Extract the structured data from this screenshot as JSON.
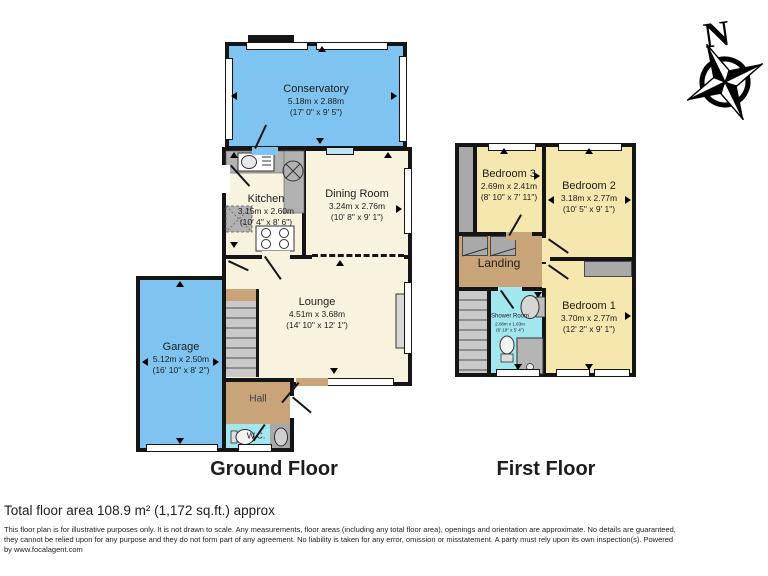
{
  "page": {
    "ground_floor_label": "Ground Floor",
    "first_floor_label": "First Floor",
    "compass_north": "N",
    "total_area": "Total floor area 108.9 m² (1,172 sq.ft.) approx",
    "disclaimer": [
      "This floor plan is for illustrative purposes only. It is not drawn to scale. Any measurements, floor areas (including any total floor area), openings and orientation are approximate. No details are guaranteed,",
      "they cannot be relied upon for any purpose and they do not form part of any agreement. No liability is taken for any error, omission or misstatement. A party must rely upon its own inspection(s). Powered",
      "by www.focalagent.com"
    ]
  },
  "rooms": {
    "conservatory": {
      "name": "Conservatory",
      "metric": "5.18m x 2.88m",
      "imperial": "(17' 0\" x 9' 5\")"
    },
    "kitchen": {
      "name": "Kitchen",
      "metric": "3.15m x 2.60m",
      "imperial": "(10' 4\" x 8' 6\")"
    },
    "dining_room": {
      "name": "Dining Room",
      "metric": "3.24m x 2.76m",
      "imperial": "(10' 8\" x 9' 1\")"
    },
    "lounge": {
      "name": "Lounge",
      "metric": "4.51m x 3.68m",
      "imperial": "(14' 10\" x 12' 1\")"
    },
    "garage": {
      "name": "Garage",
      "metric": "5.12m x 2.50m",
      "imperial": "(16' 10\" x 8' 2\")"
    },
    "hall": {
      "name": "Hall"
    },
    "wc": {
      "name": "W.C."
    },
    "bedroom3": {
      "name": "Bedroom 3",
      "metric": "2.69m x 2.41m",
      "imperial": "(8' 10\" x 7' 11\")"
    },
    "bedroom2": {
      "name": "Bedroom 2",
      "metric": "3.18m x 2.77m",
      "imperial": "(10' 5\" x 9' 1\")"
    },
    "bedroom1": {
      "name": "Bedroom 1",
      "metric": "3.70m x 2.77m",
      "imperial": "(12' 2\" x 9' 1\")"
    },
    "landing": {
      "name": "Landing"
    },
    "shower_room": {
      "name": "Shower Room",
      "metric": "2.08m x 1.63m",
      "imperial": "(6' 10\" x 5' 4\")"
    }
  },
  "colors": {
    "room_blue": "#7fc4f0",
    "room_cream": "#f8f3df",
    "room_yellow": "#f6e7ae",
    "room_tan": "#c9a478",
    "room_cyan": "#a2e6ee",
    "wall_black": "#151515"
  }
}
